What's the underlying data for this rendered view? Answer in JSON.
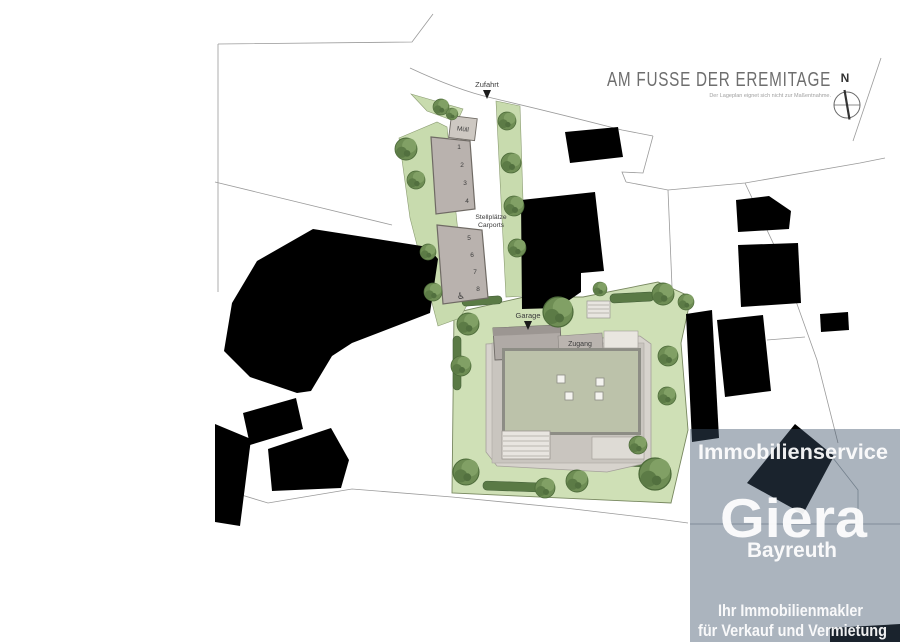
{
  "document": {
    "title": "AM FUSSE DER EREMITAGE",
    "disclaimer": "Der Lageplan eignet sich nicht zur Maßentnahme.",
    "compass_label": "N"
  },
  "plan": {
    "labels": {
      "zufahrt": "Zufahrt",
      "muell": "Müll",
      "stellplaetze_line1": "Stellplätze",
      "stellplaetze_line2": "Carports",
      "garage": "Garage",
      "zugang": "Zugang"
    },
    "carport_numbers": [
      "1",
      "2",
      "3",
      "4",
      "5",
      "6",
      "7",
      "8"
    ],
    "icons": {
      "accessible": "♿",
      "north_arrow": "compass-rose",
      "zufahrt_arrow": "down-triangle",
      "garage_arrow": "down-triangle"
    }
  },
  "watermark": {
    "line1": "Immobilienservice",
    "brand": "Giera",
    "city": "Bayreuth",
    "tagline1": "Ihr Immobilienmakler",
    "tagline2": "für Verkauf und Vermietung"
  },
  "colors": {
    "lawn": "#cfe0b6",
    "tree": "#6e8d54",
    "hedge": "#5a7a45",
    "building_footprint": "#000000",
    "roof": "#bcc2aa",
    "terrace": "#d7d3cd",
    "carport_block": "#b9b2ae",
    "parcel_line": "#9a9a9a",
    "title_text": "#6e6e6e",
    "watermark_overlay": "rgba(60,82,104,0.43)",
    "watermark_text": "#ffffff"
  }
}
